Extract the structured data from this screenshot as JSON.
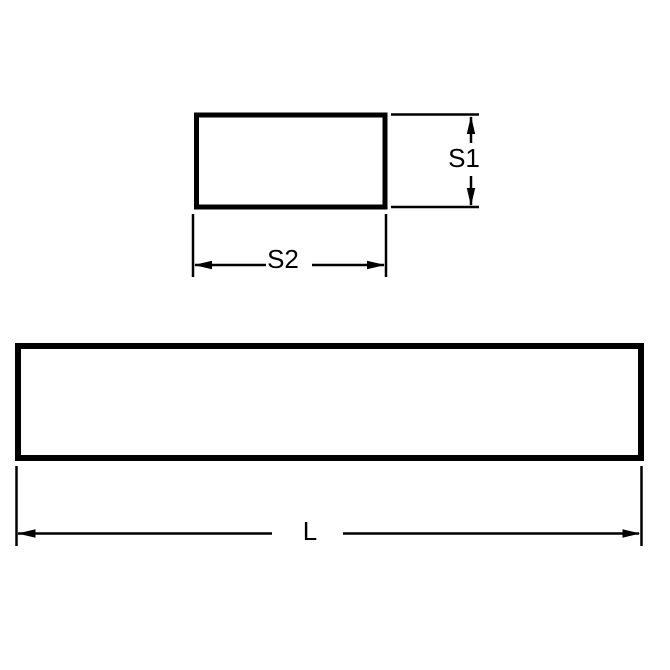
{
  "page": {
    "background_color": "#ffffff",
    "line_color": "#000000"
  },
  "diagram": {
    "cross_section_view": {
      "height_dimension_label": "S1",
      "width_dimension_label": "S2"
    },
    "length_view": {
      "length_dimension_label": "L"
    }
  }
}
